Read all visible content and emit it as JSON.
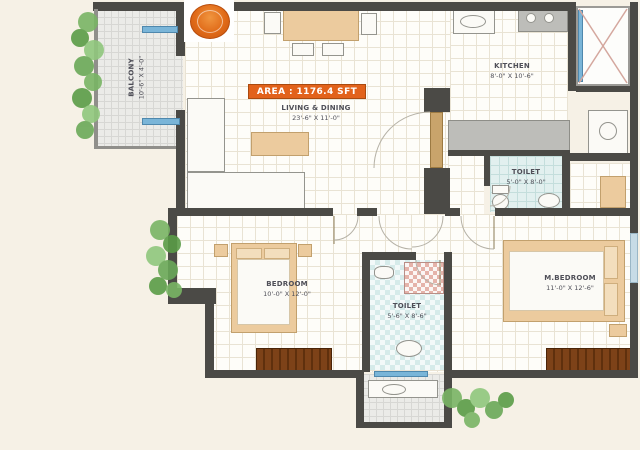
{
  "banner": {
    "area_label": "AREA : 1176.4 SFT",
    "color": "#e2621b"
  },
  "rooms": [
    {
      "name": "LIVING & DINING",
      "dims": "23'-6\" X 11'-0\""
    },
    {
      "name": "KITCHEN",
      "dims": "8'-0\" X 10'-6\""
    },
    {
      "name": "TOILET",
      "dims": "5'-0\" X 8'-0\""
    },
    {
      "name": "BEDROOM",
      "dims": "10'-0\" X 12'-0\""
    },
    {
      "name": "TOILET",
      "dims": "5'-6\" X 8'-6\""
    },
    {
      "name": "M.BEDROOM",
      "dims": "11'-0\" X 12'-6\""
    },
    {
      "name": "BALCONY",
      "dims": "10'-6\" X 4'-0\""
    }
  ],
  "colors": {
    "background": "#f6f1e6",
    "wall": "#4b4a46",
    "accent_orange": "#e2621b",
    "furniture_tan": "#eccb9e",
    "wardrobe_brown": "#7d4218",
    "toilet_cyan": "#e2f0ef",
    "window_blue": "#7ab5d8",
    "plant_green": "#6aa858"
  }
}
